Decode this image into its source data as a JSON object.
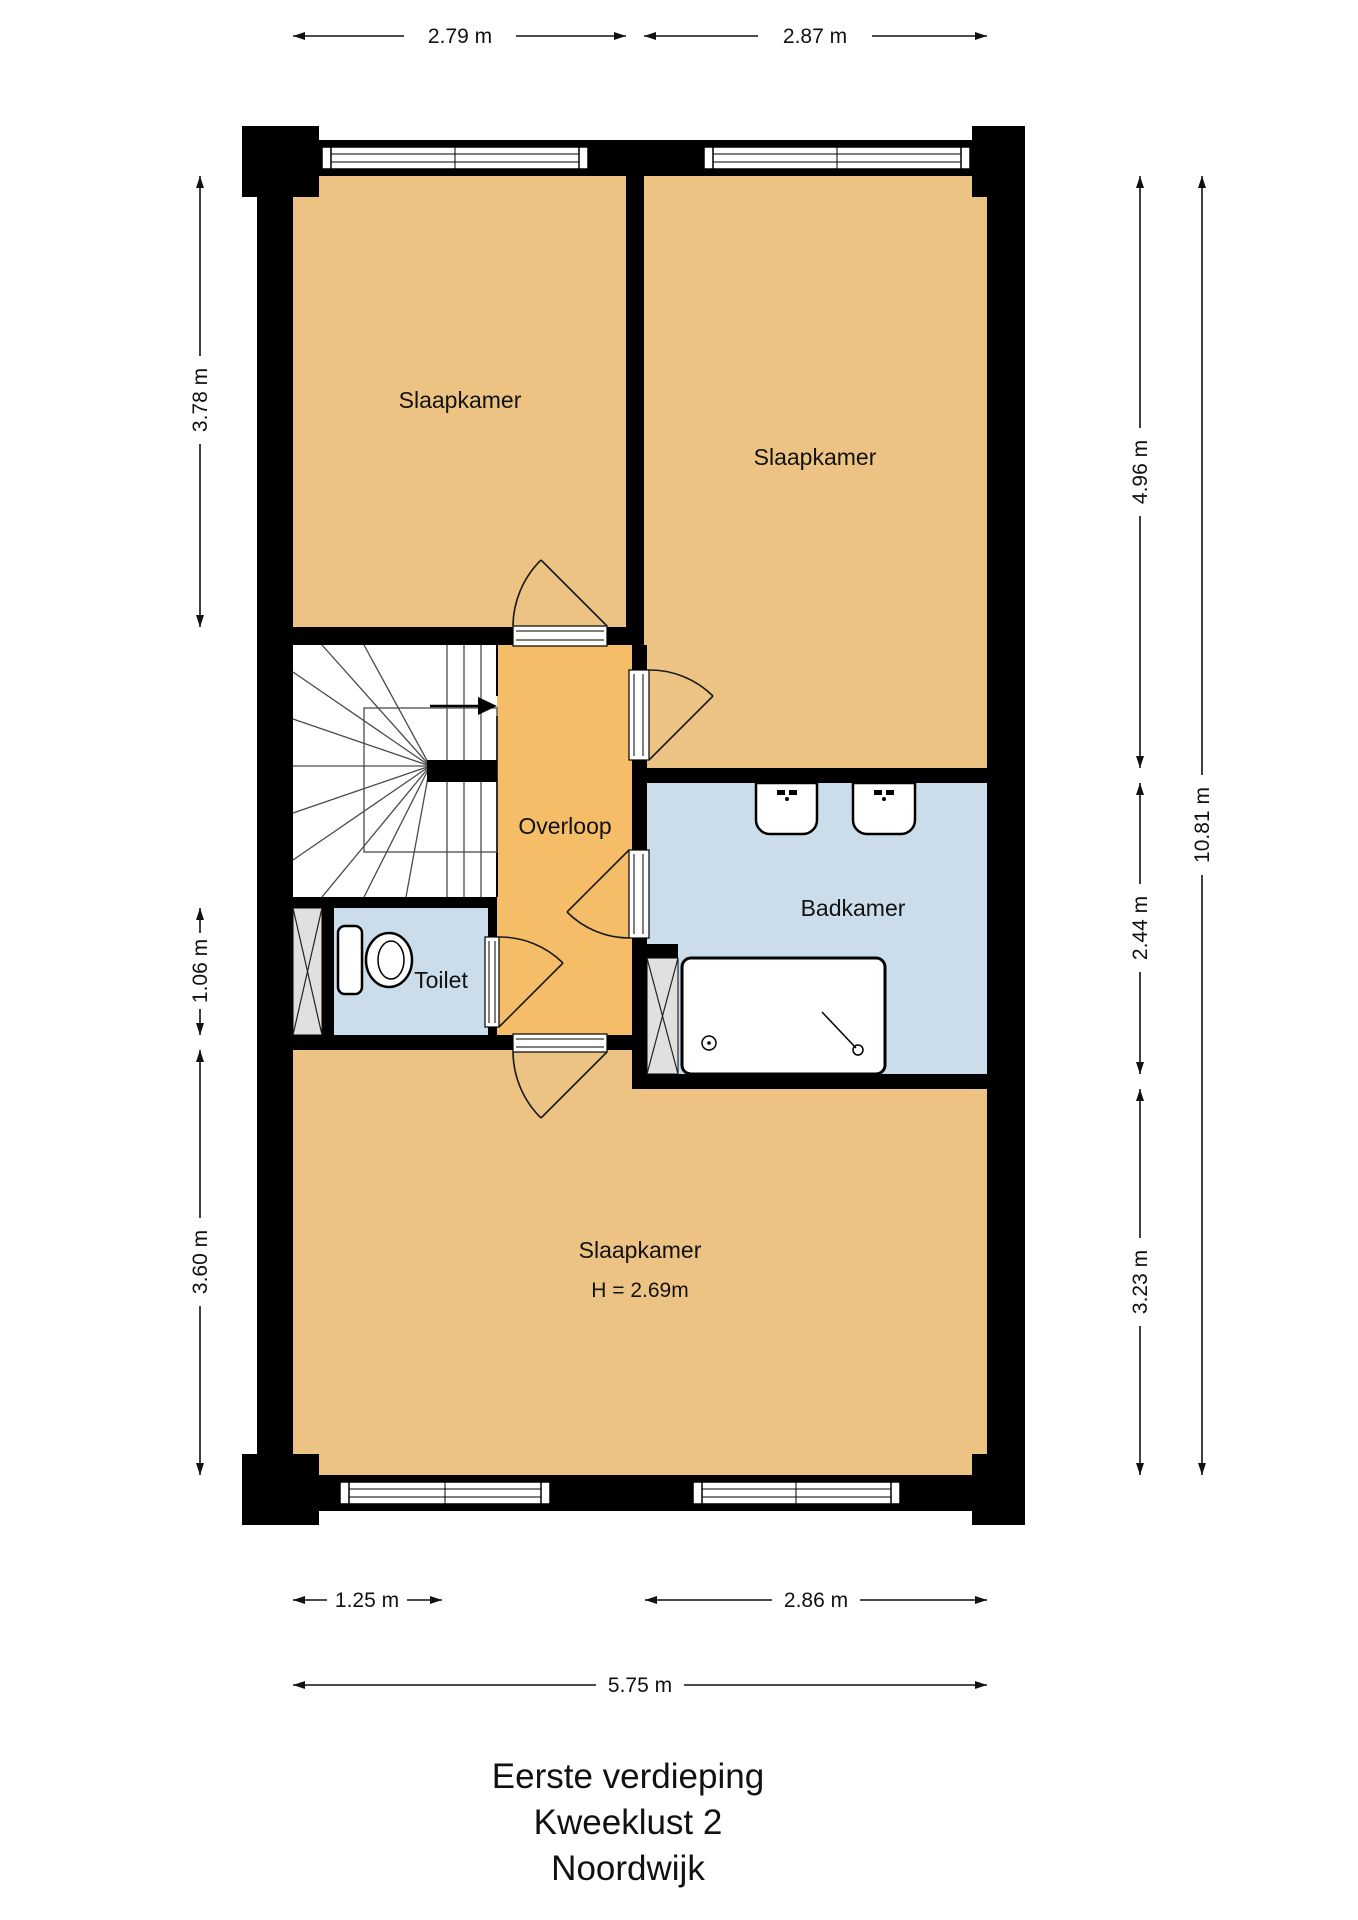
{
  "plan": {
    "rooms": {
      "bedroom_top_left": {
        "label": "Slaapkamer"
      },
      "bedroom_top_right": {
        "label": "Slaapkamer"
      },
      "landing": {
        "label": "Overloop"
      },
      "bathroom": {
        "label": "Badkamer"
      },
      "toilet": {
        "label": "Toilet"
      },
      "bedroom_bottom": {
        "label": "Slaapkamer",
        "ceiling_height": "H = 2.69m"
      }
    },
    "dimensions": {
      "top": [
        {
          "label": "2.79 m"
        },
        {
          "label": "2.87 m"
        }
      ],
      "left": [
        {
          "label": "3.78 m"
        },
        {
          "label": "1.06 m"
        },
        {
          "label": "3.60 m"
        }
      ],
      "right": [
        {
          "label": "4.96 m"
        },
        {
          "label": "2.44 m"
        },
        {
          "label": "3.23 m"
        }
      ],
      "right_total": {
        "label": "10.81 m"
      },
      "bottom": [
        {
          "label": "1.25 m"
        },
        {
          "label": "2.86 m"
        }
      ],
      "bottom_total": {
        "label": "5.75 m"
      }
    },
    "icons": [
      "staircase-icon",
      "stair-direction-arrow-icon",
      "door-arc-icon",
      "window-icon",
      "toilet-icon",
      "sink-icon",
      "shower-icon",
      "duct-cross-icon"
    ],
    "colors": {
      "room_fill": "#ECC382",
      "landing_fill": "#F5BD68",
      "wet_fill": "#CBDDEB",
      "wall": "#000000"
    }
  },
  "title": {
    "line1": "Eerste verdieping",
    "line2": "Kweeklust 2",
    "line3": "Noordwijk"
  }
}
